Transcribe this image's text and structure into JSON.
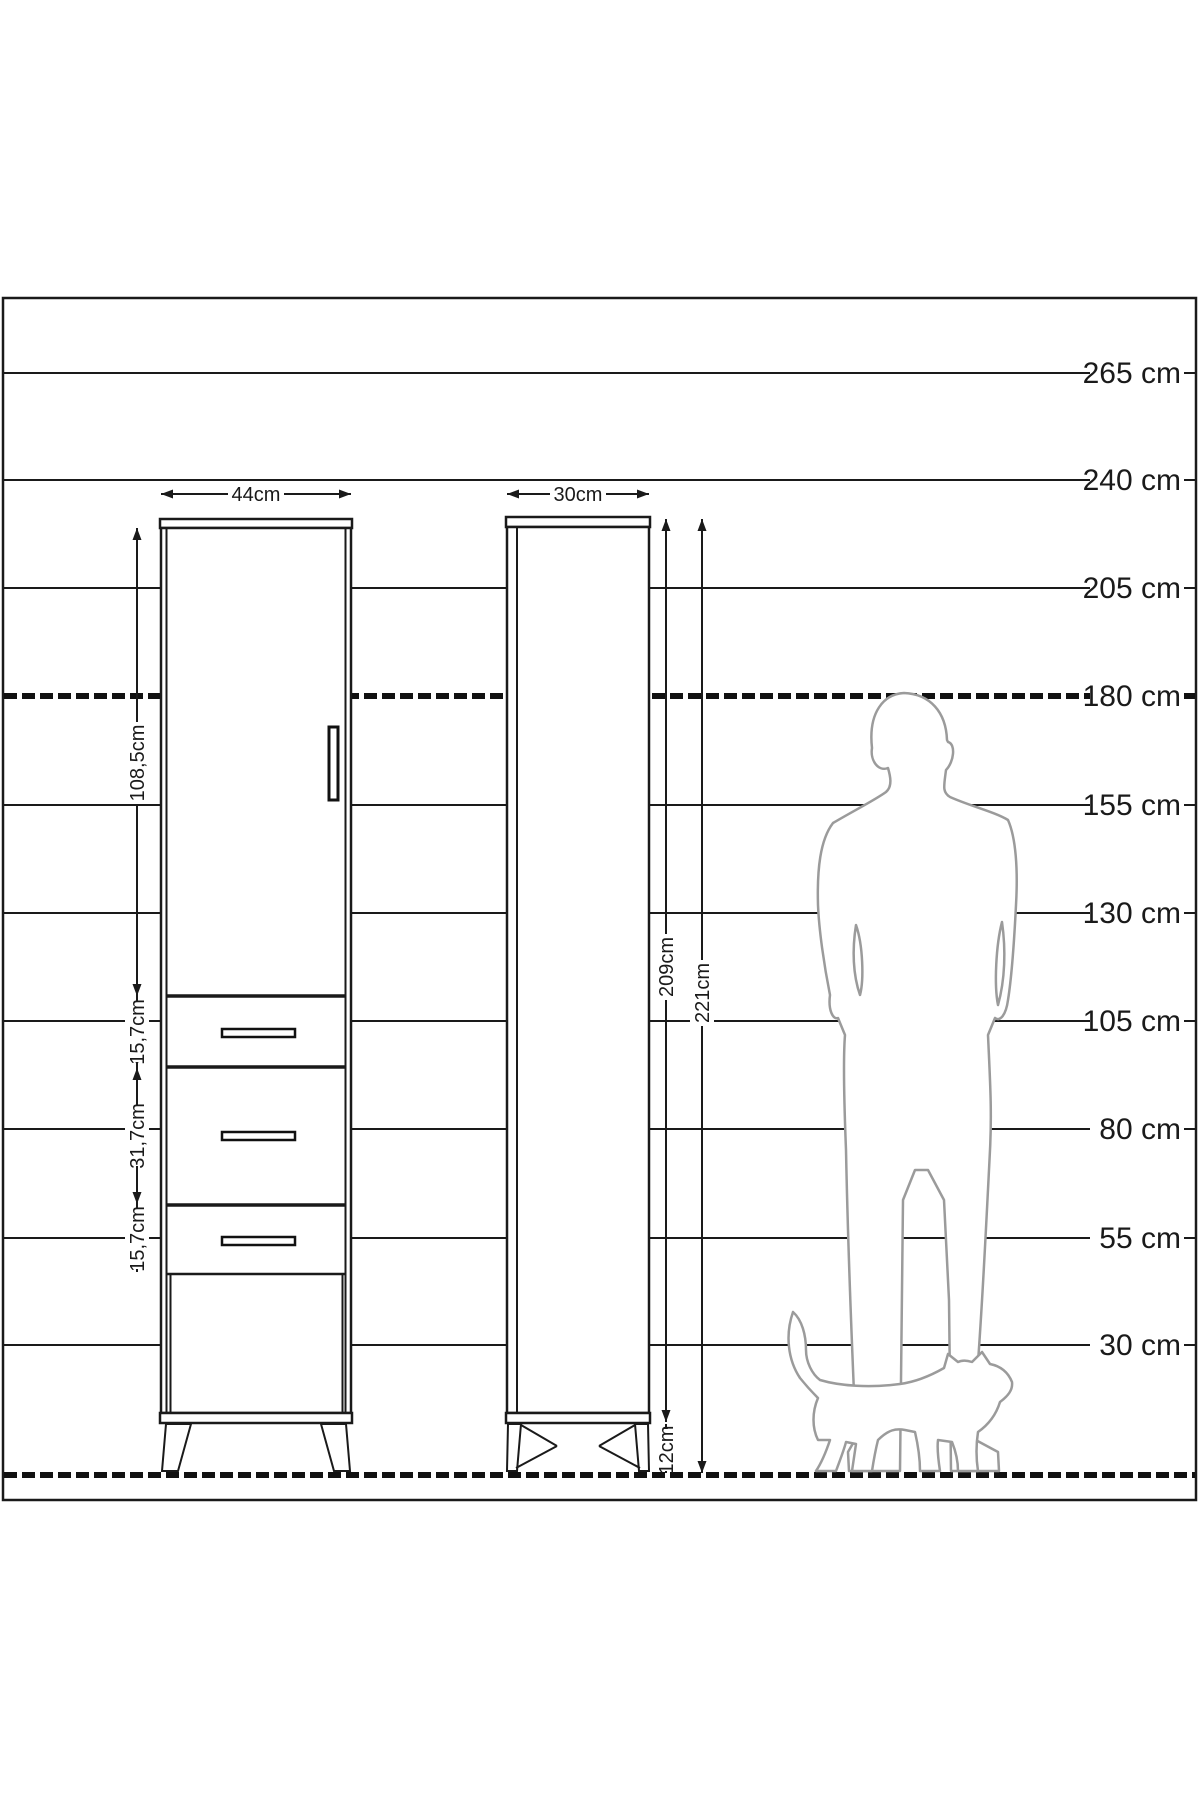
{
  "scale": {
    "labels": [
      {
        "value": "265 cm"
      },
      {
        "value": "240 cm"
      },
      {
        "value": "205 cm"
      },
      {
        "value": "180 cm"
      },
      {
        "value": "155 cm"
      },
      {
        "value": "130 cm"
      },
      {
        "value": "105 cm"
      },
      {
        "value": "80 cm"
      },
      {
        "value": "55 cm"
      },
      {
        "value": "30 cm"
      }
    ]
  },
  "cabinet": {
    "front_width": "44cm",
    "side_depth": "30cm",
    "door_height": "108,5cm",
    "drawer_top_height": "15,7cm",
    "drawer_middle_height": "31,7cm",
    "drawer_bottom_height": "15,7cm",
    "carcass_height": "209cm",
    "total_height": "221cm",
    "leg_height": "12cm"
  },
  "figures": {
    "man_icon": "man-silhouette",
    "cat_icon": "cat-silhouette"
  },
  "colors": {
    "line": "#1a1a1a",
    "silhouette": "#9b9b9b",
    "background": "#ffffff"
  }
}
